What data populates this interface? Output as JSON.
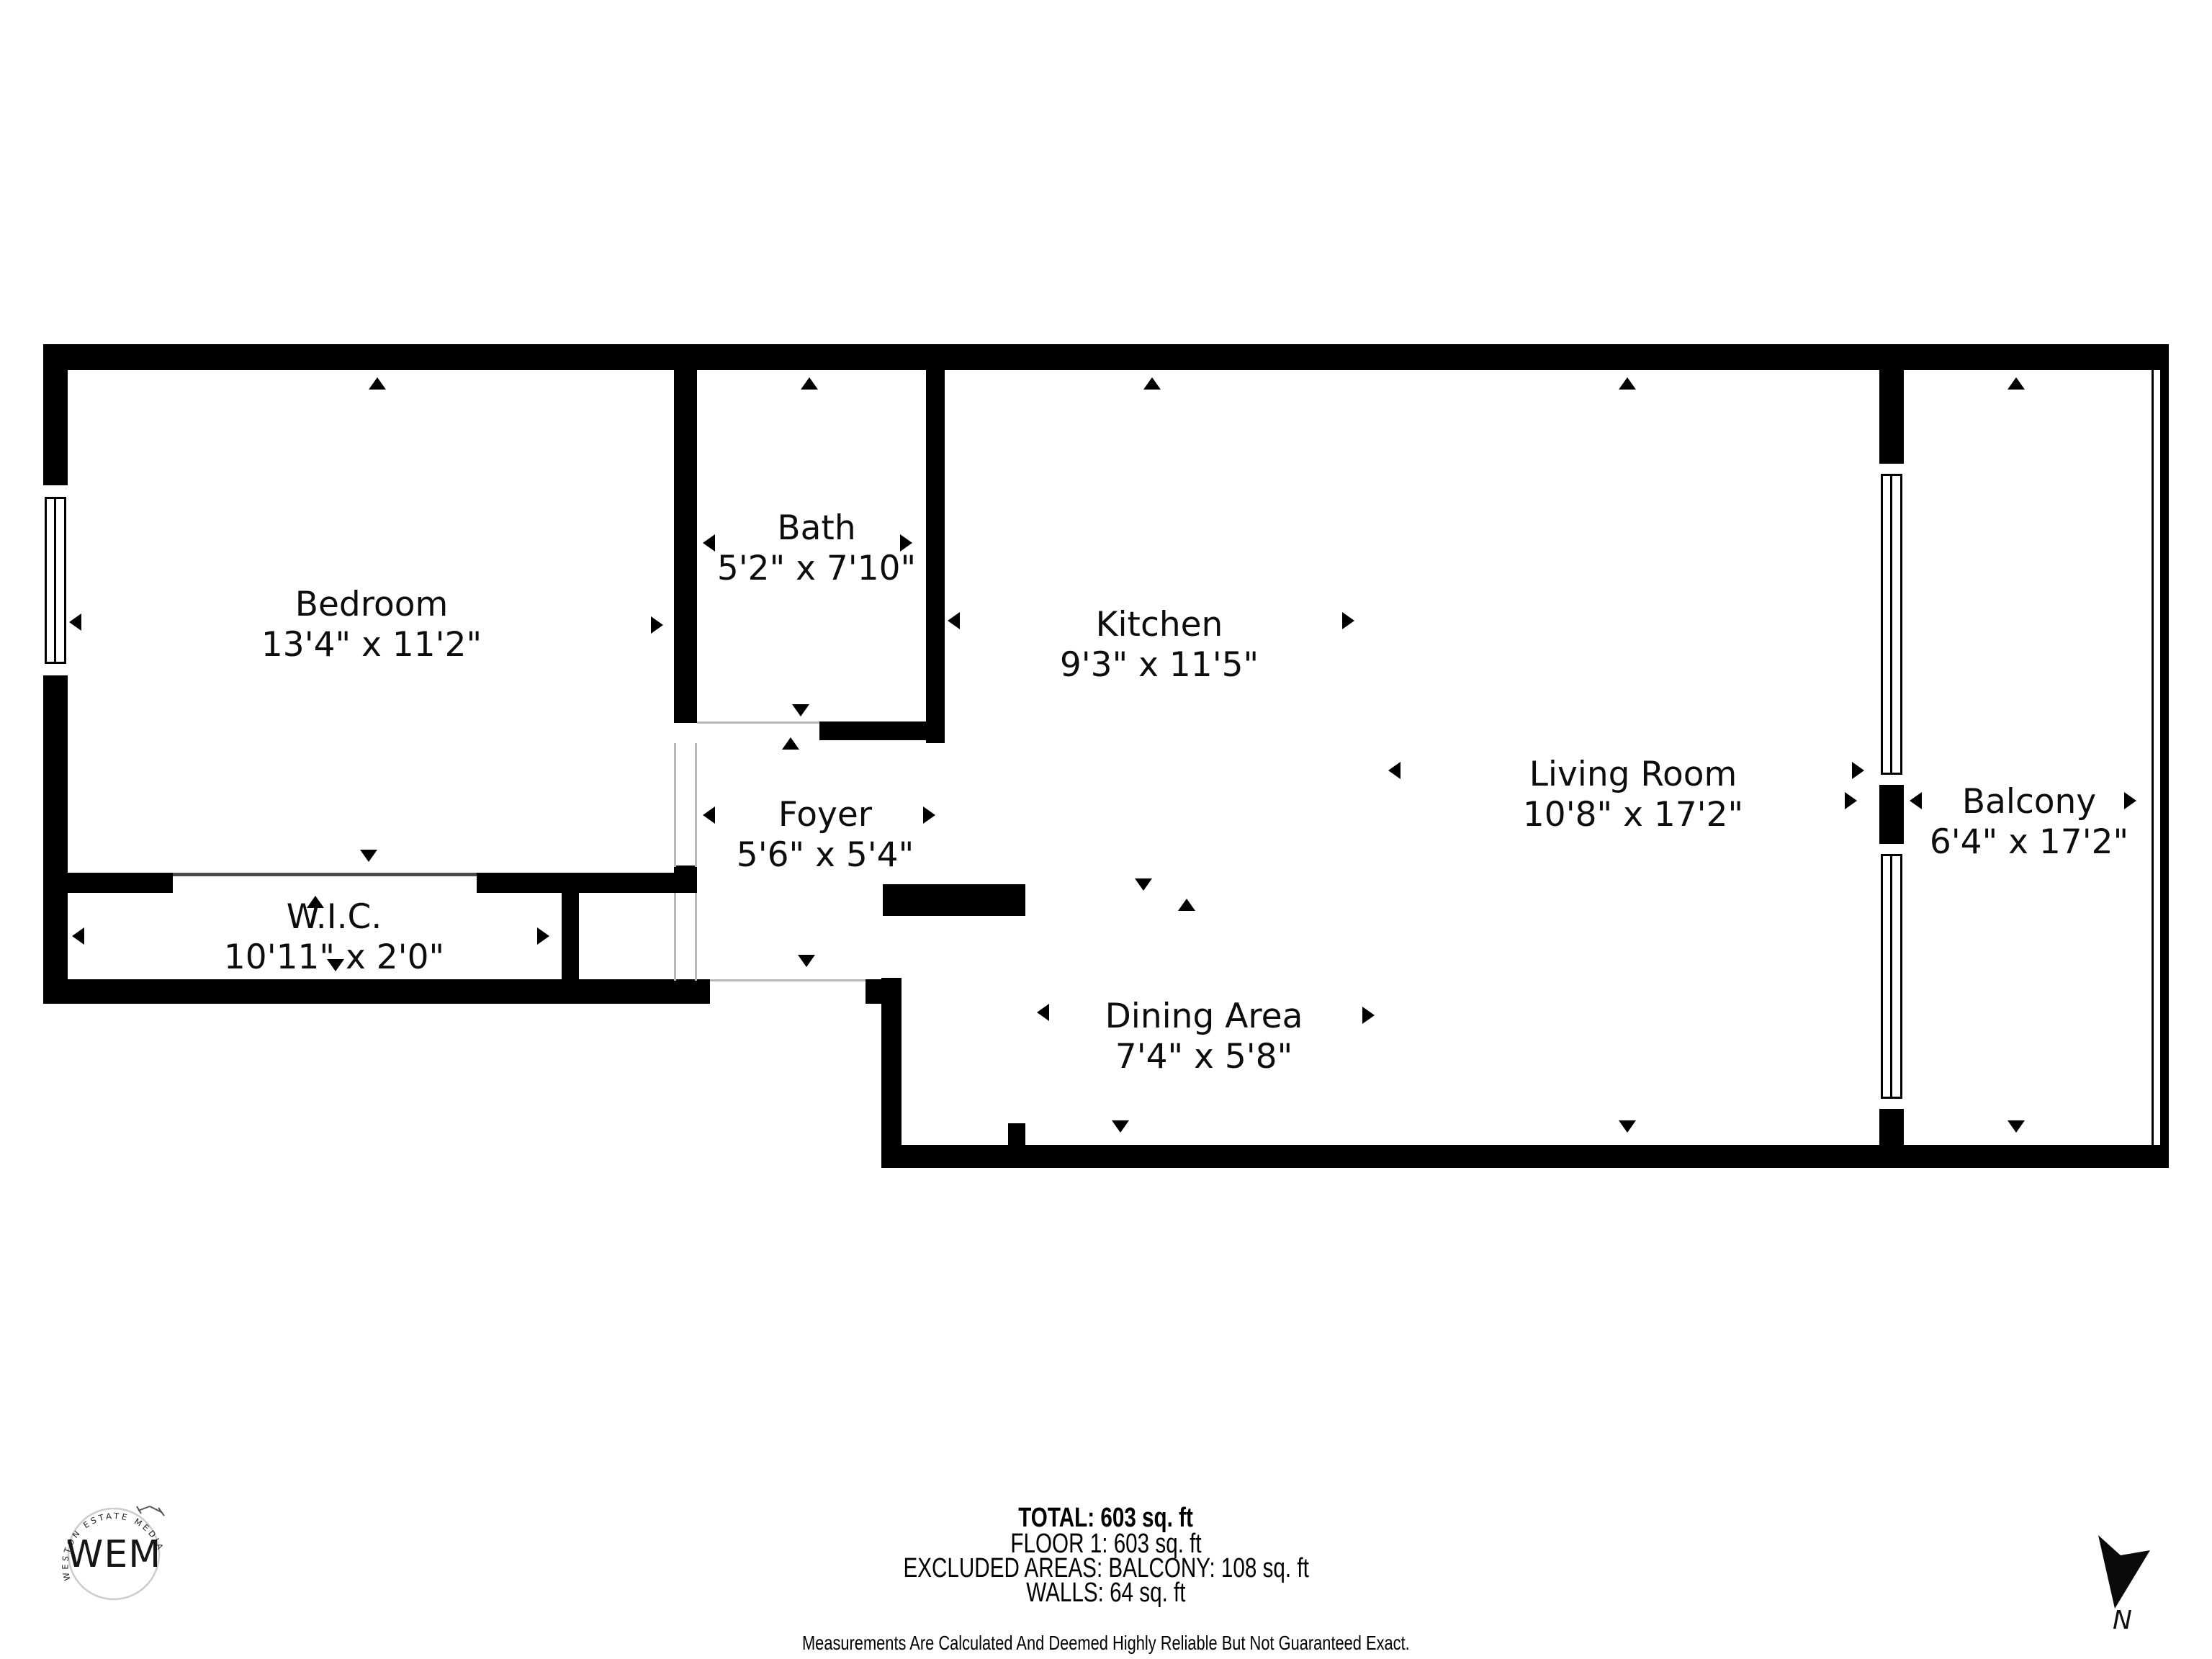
{
  "colors": {
    "wall": "#000000",
    "background": "#ffffff",
    "opening_line": "#b9b9b9",
    "logo_ring": "#cccccc"
  },
  "rooms": [
    {
      "name": "Bedroom",
      "dims": "13'4\" x 11'2\""
    },
    {
      "name": "Bath",
      "dims": "5'2\" x 7'10\""
    },
    {
      "name": "Kitchen",
      "dims": "9'3\" x 11'5\""
    },
    {
      "name": "Living Room",
      "dims": "10'8\" x 17'2\""
    },
    {
      "name": "Balcony",
      "dims": "6'4\" x 17'2\""
    },
    {
      "name": "Foyer",
      "dims": "5'6\" x 5'4\""
    },
    {
      "name": "W.I.C.",
      "dims": "10'11\" x 2'0\""
    },
    {
      "name": "Dining Area",
      "dims": "7'4\" x 5'8\""
    }
  ],
  "footer": {
    "total": "TOTAL: 603 sq. ft",
    "floor": "FLOOR 1: 603 sq. ft",
    "excluded": "EXCLUDED AREAS: BALCONY: 108 sq. ft",
    "walls": "WALLS: 64 sq. ft",
    "disclaimer": "Measurements Are Calculated And Deemed Highly Reliable But Not Guaranteed Exact."
  },
  "logo": {
    "monogram": "WEM",
    "ring_text": "WESTON ESTATE MEDIA"
  },
  "compass": {
    "label": "N"
  }
}
